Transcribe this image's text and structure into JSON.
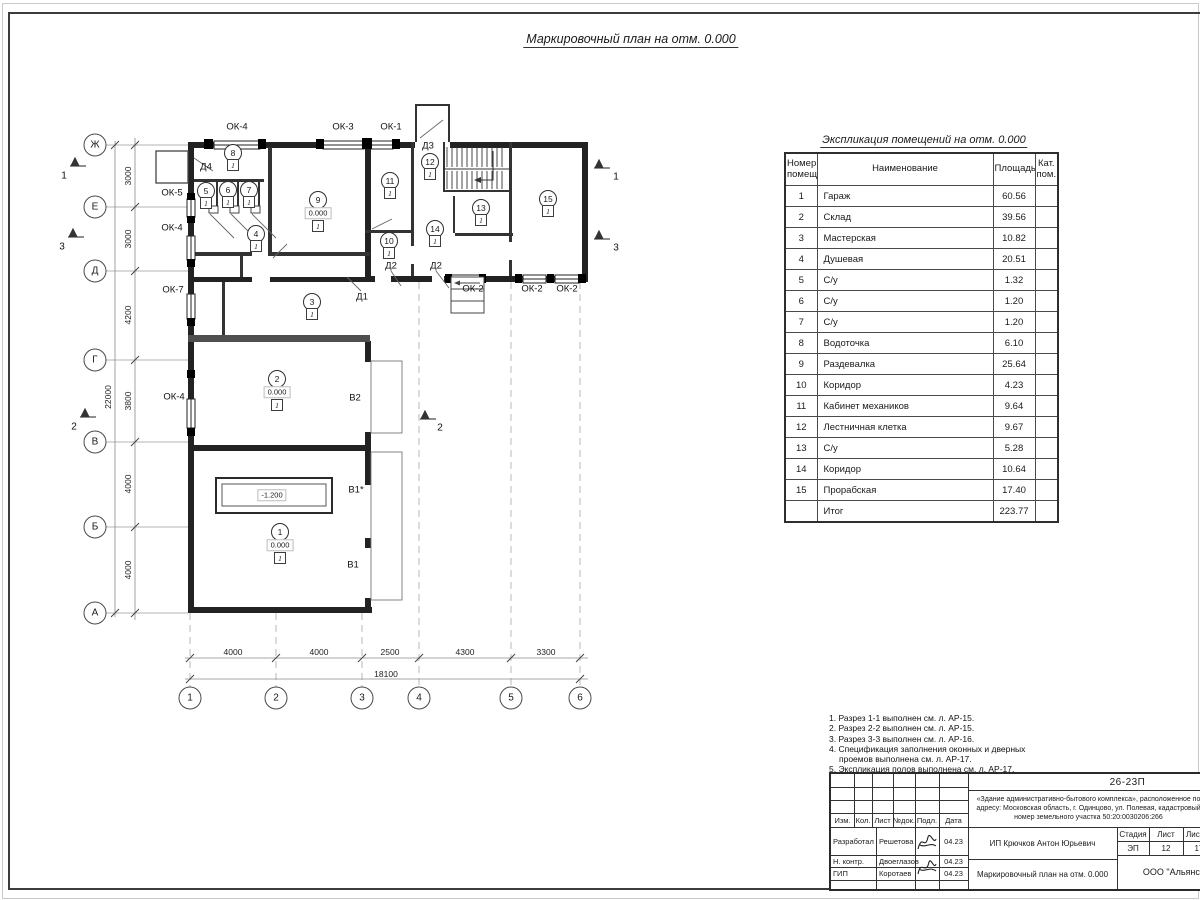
{
  "sheet": {
    "title": "Маркировочный план на отм. 0.000"
  },
  "plan": {
    "axis_rows": [
      {
        "label": "Ж",
        "y": 145
      },
      {
        "label": "Е",
        "y": 207
      },
      {
        "label": "Д",
        "y": 271
      },
      {
        "label": "Г",
        "y": 360
      },
      {
        "label": "В",
        "y": 442
      },
      {
        "label": "Б",
        "y": 527
      },
      {
        "label": "А",
        "y": 613
      }
    ],
    "axis_cols": [
      {
        "label": "1",
        "x": 190
      },
      {
        "label": "2",
        "x": 276
      },
      {
        "label": "3",
        "x": 362
      },
      {
        "label": "4",
        "x": 419
      },
      {
        "label": "5",
        "x": 511
      },
      {
        "label": "6",
        "x": 580
      }
    ],
    "dims_left": [
      {
        "v": "3000",
        "y": 176
      },
      {
        "v": "3000",
        "y": 239
      },
      {
        "v": "4200",
        "y": 315
      },
      {
        "v": "3800",
        "y": 401
      },
      {
        "v": "4000",
        "y": 484
      },
      {
        "v": "4000",
        "y": 570
      }
    ],
    "dim_left_total": {
      "v": "22000",
      "y": 397
    },
    "dims_bottom": [
      {
        "v": "4000",
        "x": 233
      },
      {
        "v": "4000",
        "x": 319
      },
      {
        "v": "2500",
        "x": 390
      },
      {
        "v": "4300",
        "x": 465
      },
      {
        "v": "3300",
        "x": 546
      }
    ],
    "dim_bottom_total": {
      "v": "18100",
      "x": 386
    },
    "labels": [
      {
        "t": "ОК-4",
        "x": 237,
        "y": 127,
        "k": "window-label"
      },
      {
        "t": "ОК-3",
        "x": 343,
        "y": 127,
        "k": "window-label"
      },
      {
        "t": "ОК-1",
        "x": 391,
        "y": 127,
        "k": "window-label"
      },
      {
        "t": "ОК-5",
        "x": 172,
        "y": 193,
        "k": "window-label"
      },
      {
        "t": "ОК-4",
        "x": 172,
        "y": 228,
        "k": "window-label"
      },
      {
        "t": "ОК-7",
        "x": 173,
        "y": 290,
        "k": "window-label"
      },
      {
        "t": "ОК-4",
        "x": 174,
        "y": 397,
        "k": "window-label"
      },
      {
        "t": "ОК-2",
        "x": 473,
        "y": 289,
        "k": "window-label"
      },
      {
        "t": "ОК-2",
        "x": 532,
        "y": 289,
        "k": "window-label"
      },
      {
        "t": "ОК-2",
        "x": 567,
        "y": 289,
        "k": "window-label"
      },
      {
        "t": "Д4",
        "x": 206,
        "y": 167,
        "k": "door-label"
      },
      {
        "t": "Д3",
        "x": 428,
        "y": 146,
        "k": "door-label"
      },
      {
        "t": "Д2",
        "x": 391,
        "y": 266,
        "k": "door-label"
      },
      {
        "t": "Д2",
        "x": 436,
        "y": 266,
        "k": "door-label"
      },
      {
        "t": "Д1",
        "x": 362,
        "y": 297,
        "k": "door-label"
      },
      {
        "t": "В2",
        "x": 355,
        "y": 398,
        "k": "gate-label"
      },
      {
        "t": "В1*",
        "x": 356,
        "y": 490,
        "k": "gate-label"
      },
      {
        "t": "В1",
        "x": 353,
        "y": 565,
        "k": "gate-label"
      }
    ],
    "sections": [
      {
        "n": "1",
        "x": 64,
        "y": 176
      },
      {
        "n": "3",
        "x": 62,
        "y": 247
      },
      {
        "n": "2",
        "x": 74,
        "y": 427
      },
      {
        "n": "1",
        "x": 616,
        "y": 177
      },
      {
        "n": "3",
        "x": 616,
        "y": 248
      },
      {
        "n": "2",
        "x": 440,
        "y": 428
      }
    ],
    "rooms": [
      {
        "n": "1",
        "x": 280,
        "y": 532,
        "elev": "0.000",
        "floor": "1"
      },
      {
        "n": "2",
        "x": 277,
        "y": 379,
        "elev": "0.000",
        "floor": "1"
      },
      {
        "n": "3",
        "x": 312,
        "y": 302,
        "floor": "1"
      },
      {
        "n": "4",
        "x": 256,
        "y": 234,
        "floor": "1"
      },
      {
        "n": "5",
        "x": 206,
        "y": 191,
        "floor": "1"
      },
      {
        "n": "6",
        "x": 228,
        "y": 190,
        "floor": "1"
      },
      {
        "n": "7",
        "x": 249,
        "y": 190,
        "floor": "1"
      },
      {
        "n": "8",
        "x": 233,
        "y": 153,
        "floor": "1"
      },
      {
        "n": "9",
        "x": 318,
        "y": 200,
        "elev": "0.000",
        "floor": "1"
      },
      {
        "n": "10",
        "x": 389,
        "y": 241,
        "floor": "1"
      },
      {
        "n": "11",
        "x": 390,
        "y": 181,
        "floor": "1"
      },
      {
        "n": "12",
        "x": 430,
        "y": 162,
        "floor": "1"
      },
      {
        "n": "13",
        "x": 481,
        "y": 208,
        "floor": "1"
      },
      {
        "n": "14",
        "x": 435,
        "y": 229,
        "floor": "1"
      },
      {
        "n": "15",
        "x": 548,
        "y": 199,
        "floor": "1"
      }
    ],
    "pit_elevation": "-1.200"
  },
  "explication": {
    "title": "Экспликация помещений на отм. 0.000",
    "col_num": "Номер помещ.",
    "col_name": "Наименование",
    "col_area": "Площадь,",
    "col_cat": "Кат. пом.",
    "rows": [
      [
        "1",
        "Гараж",
        "60.56"
      ],
      [
        "2",
        "Склад",
        "39.56"
      ],
      [
        "3",
        "Мастерская",
        "10.82"
      ],
      [
        "4",
        "Душевая",
        "20.51"
      ],
      [
        "5",
        "С/у",
        "1.32"
      ],
      [
        "6",
        "С/у",
        "1.20"
      ],
      [
        "7",
        "С/у",
        "1.20"
      ],
      [
        "8",
        "Водоточка",
        "6.10"
      ],
      [
        "9",
        "Раздевалка",
        "25.64"
      ],
      [
        "10",
        "Коридор",
        "4.23"
      ],
      [
        "11",
        "Кабинет механиков",
        "9.64"
      ],
      [
        "12",
        "Лестничная клетка",
        "9.67"
      ],
      [
        "13",
        "С/у",
        "5.28"
      ],
      [
        "14",
        "Коридор",
        "10.64"
      ],
      [
        "15",
        "Прорабская",
        "17.40"
      ]
    ],
    "total_label": "Итог",
    "total_value": "223.77"
  },
  "notes": [
    "1. Разрез 1-1 выполнен см. л. АР-15.",
    "2. Разрез 2-2 выполнен см. л. АР-15.",
    "3. Разрез 3-3 выполнен см. л. АР-16.",
    "4. Спецификация заполнения оконных и дверных проемов выполнена см. л. АР-17.",
    "5. Экспликация полов выполнена см. л. АР-17."
  ],
  "titleblock": {
    "code": "26-23П",
    "object": "«Здание административно-бытового комплекса», расположенное по адресу: Московская область, г. Одинцово, ул. Полевая, кадастровый номер земельного участка 50:20:0030206:266",
    "client": "ИП Крючков Антон Юрьевич",
    "doc_title": "Маркировочный план на отм. 0.000",
    "org": "ООО \"Альянс\"",
    "header_cells": [
      "Изм.",
      "Кол.",
      "Лист",
      "№док.",
      "Подл.",
      "Дата"
    ],
    "stage_label": "Стадия",
    "sheet_label": "Лист",
    "sheets_label": "Листов",
    "stage": "ЭП",
    "sheet_no": "12",
    "sheets_total": "17",
    "roles": [
      {
        "role": "Разработал",
        "name": "Решетова",
        "date": "04.23"
      },
      {
        "role": "Н. контр.",
        "name": "Двоеглазов",
        "date": "04.23"
      },
      {
        "role": "ГИП",
        "name": "Коротаев",
        "date": "04.23"
      }
    ]
  }
}
